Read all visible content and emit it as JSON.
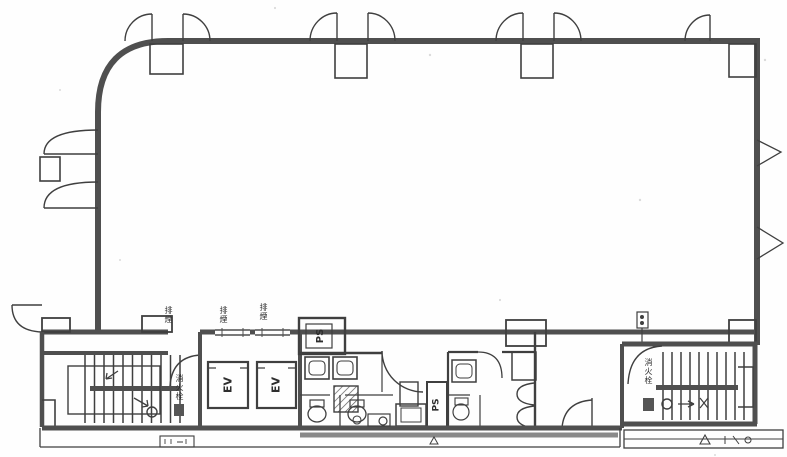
{
  "page": {
    "background": "#fefefe",
    "ink": "#3f3f3f",
    "wall": "#4f4f4f"
  },
  "plan": {
    "elevator_shaft_1": {
      "label": "EV"
    },
    "elevator_shaft_2": {
      "label": "EV"
    },
    "pipe_shaft_top": {
      "label": "PS"
    },
    "pipe_shaft_mid": {
      "label": "PS"
    },
    "smoke_vent_labels": [
      "排煙",
      "排煙",
      "排煙"
    ],
    "stair_left": {
      "equipment_label": "消火栓"
    },
    "stair_right": {
      "equipment_label": "消火栓"
    }
  }
}
